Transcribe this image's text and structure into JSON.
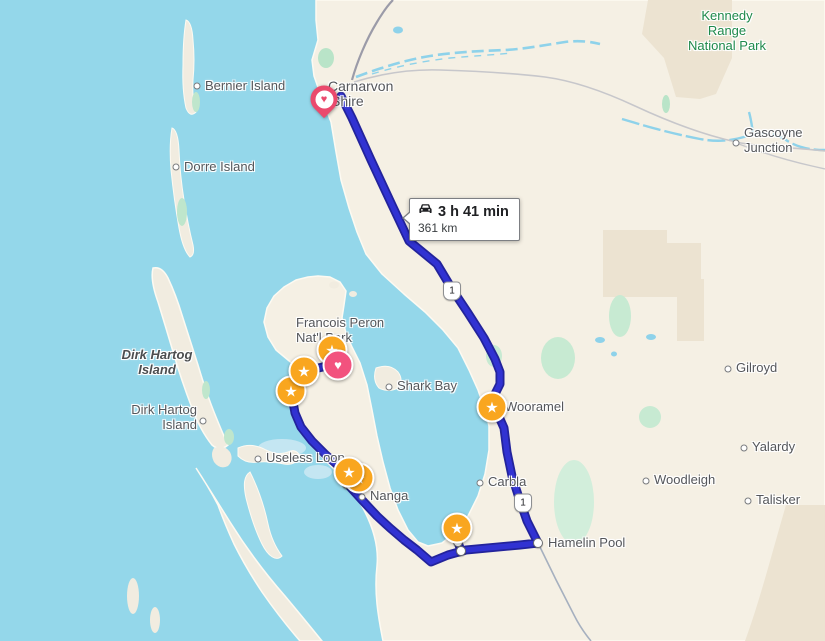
{
  "app": {
    "title": "Map route view — Shark Bay / Carnarvon, Western Australia"
  },
  "tooltip": {
    "duration": "3 h 41 min",
    "distance": "361 km",
    "icon": "car-icon"
  },
  "colors": {
    "water": "#94d7ea",
    "land": "#f5f0e4",
    "land_shade": "#ece3d1",
    "vegetation": "#c7ead2",
    "park_label": "#1f8a4c",
    "route_core": "#3132d2",
    "route_casing": "#23239b",
    "road_major": "#9b9ba8",
    "road_minor": "#c7c7cb",
    "river": "#8ed2ea",
    "star_marker": "#f9a61f",
    "heart_marker": "#f2527e",
    "label_text": "#54565a"
  },
  "shields": [
    {
      "label": "1",
      "x": 452,
      "y": 291
    },
    {
      "label": "1",
      "x": 523,
      "y": 503
    }
  ],
  "labels": [
    {
      "id": "kennedy-range-national-park",
      "lines": [
        "Kennedy",
        "Range",
        "National Park"
      ],
      "x": 727,
      "y": 8,
      "style": "park center"
    },
    {
      "id": "gascoyne-junction",
      "lines": [
        "Gascoyne",
        "Junction"
      ],
      "x": 744,
      "y": 125,
      "style": "locality",
      "dot": {
        "x": 736,
        "y": 143
      }
    },
    {
      "id": "bernier-island",
      "lines": [
        "Bernier Island"
      ],
      "x": 205,
      "y": 78,
      "style": "locality",
      "dot": {
        "x": 197,
        "y": 86
      }
    },
    {
      "id": "dorre-island",
      "lines": [
        "Dorre Island"
      ],
      "x": 184,
      "y": 159,
      "style": "locality",
      "dot": {
        "x": 176,
        "y": 167
      }
    },
    {
      "id": "carnarvon",
      "lines": [
        "Carnarvon"
      ],
      "x": 328,
      "y": 79,
      "style": "town"
    },
    {
      "id": "carnarvon-shire",
      "lines": [
        "Shire"
      ],
      "x": 331,
      "y": 94,
      "style": "town"
    },
    {
      "id": "dirk-hartog-island-feature",
      "lines": [
        "Dirk Hartog",
        "Island"
      ],
      "x": 157,
      "y": 347,
      "style": "feature center"
    },
    {
      "id": "dirk-hartog-island-locality",
      "lines": [
        "Dirk Hartog",
        "Island"
      ],
      "x": 197,
      "y": 402,
      "style": "locality right",
      "dot": {
        "x": 203,
        "y": 421
      }
    },
    {
      "id": "francois-peron-natl-park",
      "lines": [
        "Francois Peron",
        "Nat'l Park"
      ],
      "x": 296,
      "y": 315,
      "style": "locality"
    },
    {
      "id": "shark-bay",
      "lines": [
        "Shark Bay"
      ],
      "x": 397,
      "y": 378,
      "style": "locality",
      "dot": {
        "x": 389,
        "y": 387
      }
    },
    {
      "id": "useless-loop",
      "lines": [
        "Useless Loop"
      ],
      "x": 266,
      "y": 450,
      "style": "locality",
      "dot": {
        "x": 258,
        "y": 459
      }
    },
    {
      "id": "nanga",
      "lines": [
        "Nanga"
      ],
      "x": 370,
      "y": 488,
      "style": "locality",
      "dot": {
        "x": 362,
        "y": 497
      }
    },
    {
      "id": "wooramel",
      "lines": [
        "Wooramel"
      ],
      "x": 505,
      "y": 399,
      "style": "locality"
    },
    {
      "id": "carbla",
      "lines": [
        "Carbla"
      ],
      "x": 488,
      "y": 474,
      "style": "locality",
      "dot": {
        "x": 480,
        "y": 483
      }
    },
    {
      "id": "hamelin-pool",
      "lines": [
        "Hamelin Pool"
      ],
      "x": 548,
      "y": 535,
      "style": "locality"
    },
    {
      "id": "gilroyd",
      "lines": [
        "Gilroyd"
      ],
      "x": 736,
      "y": 360,
      "style": "locality",
      "dot": {
        "x": 728,
        "y": 369
      }
    },
    {
      "id": "yalardy",
      "lines": [
        "Yalardy"
      ],
      "x": 752,
      "y": 439,
      "style": "locality",
      "dot": {
        "x": 744,
        "y": 448
      }
    },
    {
      "id": "woodleigh",
      "lines": [
        "Woodleigh"
      ],
      "x": 654,
      "y": 472,
      "style": "locality",
      "dot": {
        "x": 646,
        "y": 481
      }
    },
    {
      "id": "talisker",
      "lines": [
        "Talisker"
      ],
      "x": 756,
      "y": 492,
      "style": "locality",
      "dot": {
        "x": 748,
        "y": 501
      }
    }
  ],
  "markers": {
    "star_glyph": "★",
    "heart_glyph": "♥",
    "stars": [
      {
        "x": 291,
        "y": 391
      },
      {
        "x": 304,
        "y": 371
      },
      {
        "x": 332,
        "y": 350
      },
      {
        "x": 359,
        "y": 478
      },
      {
        "x": 349,
        "y": 472
      },
      {
        "x": 457,
        "y": 528
      },
      {
        "x": 492,
        "y": 407
      }
    ],
    "heart_circles": [
      {
        "x": 338,
        "y": 365
      }
    ],
    "heart_pins": [
      {
        "x": 324,
        "y": 99
      }
    ],
    "waypoints": [
      {
        "x": 293,
        "y": 401
      },
      {
        "x": 347,
        "y": 484
      },
      {
        "x": 458,
        "y": 542
      },
      {
        "x": 461,
        "y": 551
      },
      {
        "x": 538,
        "y": 543
      }
    ]
  }
}
